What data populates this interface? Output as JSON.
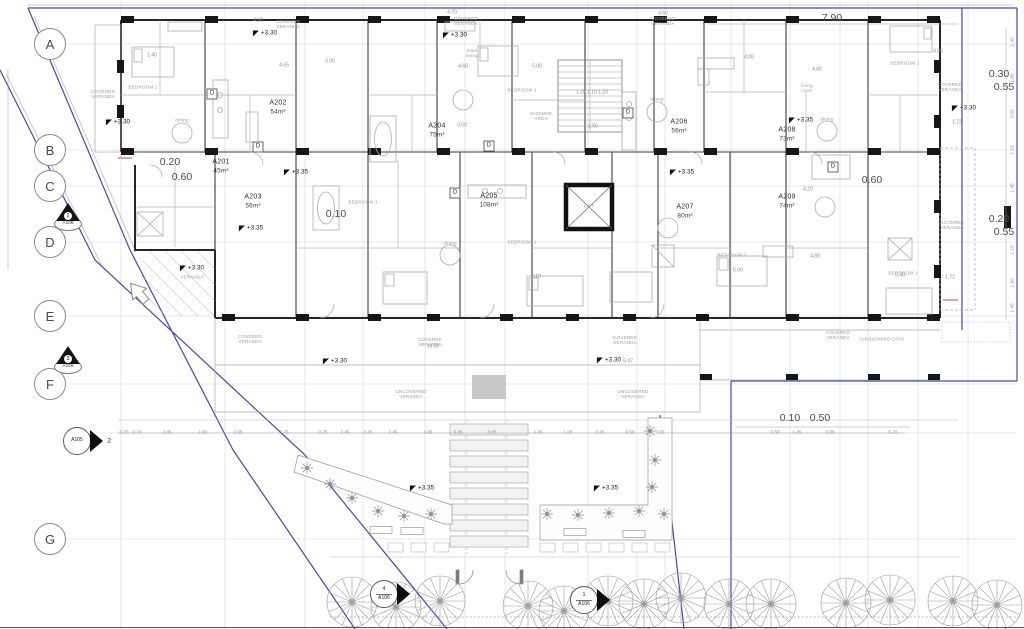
{
  "grid": {
    "x": 50,
    "rows": [
      {
        "label": "A",
        "y": 44
      },
      {
        "label": "B",
        "y": 150
      },
      {
        "label": "C",
        "y": 186
      },
      {
        "label": "D",
        "y": 242
      },
      {
        "label": "E",
        "y": 316
      },
      {
        "label": "F",
        "y": 384
      },
      {
        "label": "G",
        "y": 539
      }
    ]
  },
  "apartments": [
    {
      "id": "A201",
      "area": "45m²",
      "x": 221,
      "y": 167
    },
    {
      "id": "A202",
      "area": "54m²",
      "x": 278,
      "y": 108
    },
    {
      "id": "A203",
      "area": "56m²",
      "x": 253,
      "y": 202
    },
    {
      "id": "A204",
      "area": "75m²",
      "x": 437,
      "y": 131
    },
    {
      "id": "A205",
      "area": "108m²",
      "x": 489,
      "y": 201
    },
    {
      "id": "A206",
      "area": "56m²",
      "x": 679,
      "y": 127
    },
    {
      "id": "A207",
      "area": "80m²",
      "x": 685,
      "y": 212
    },
    {
      "id": "A208",
      "area": "73m²",
      "x": 787,
      "y": 135
    },
    {
      "id": "A209",
      "area": "74m²",
      "x": 787,
      "y": 202
    }
  ],
  "levels": [
    {
      "label": "+3.30",
      "x": 118,
      "y": 122
    },
    {
      "label": "+3.30",
      "x": 265,
      "y": 33
    },
    {
      "label": "+3.30",
      "x": 455,
      "y": 35
    },
    {
      "label": "+3.30",
      "x": 964,
      "y": 108
    },
    {
      "label": "+3.30",
      "x": 192,
      "y": 268
    },
    {
      "label": "+3.30",
      "x": 335,
      "y": 361
    },
    {
      "label": "+3.30",
      "x": 609,
      "y": 360
    },
    {
      "label": "+3.35",
      "x": 296,
      "y": 172
    },
    {
      "label": "+3.35",
      "x": 251,
      "y": 228
    },
    {
      "label": "+3.35",
      "x": 682,
      "y": 172
    },
    {
      "label": "+3.35",
      "x": 801,
      "y": 120
    },
    {
      "label": "+3.35",
      "x": 422,
      "y": 488
    },
    {
      "label": "+3.35",
      "x": 606,
      "y": 488
    }
  ],
  "dimensions_large": [
    {
      "v": "0.20",
      "x": 170,
      "y": 163
    },
    {
      "v": "0.60",
      "x": 182,
      "y": 178
    },
    {
      "v": "0.10",
      "x": 336,
      "y": 215
    },
    {
      "v": "0.60",
      "x": 872,
      "y": 181
    },
    {
      "v": "7.90",
      "x": 832,
      "y": 19
    },
    {
      "v": "0.30",
      "x": 999,
      "y": 75
    },
    {
      "v": "0.55",
      "x": 1004,
      "y": 88
    },
    {
      "v": "0.20",
      "x": 999,
      "y": 220
    },
    {
      "v": "0.55",
      "x": 1004,
      "y": 233
    },
    {
      "v": "0.10",
      "x": 790,
      "y": 419
    },
    {
      "v": "0.50",
      "x": 820,
      "y": 419
    }
  ],
  "dimensions_small": [
    {
      "v": "4.50",
      "x": 258,
      "y": 21
    },
    {
      "v": "4.70",
      "x": 452,
      "y": 13
    },
    {
      "v": "4.50",
      "x": 663,
      "y": 14
    },
    {
      "v": "1.40",
      "x": 152,
      "y": 56
    },
    {
      "v": "3.00",
      "x": 330,
      "y": 62
    },
    {
      "v": "4.65",
      "x": 284,
      "y": 66
    },
    {
      "v": "4.60",
      "x": 463,
      "y": 67
    },
    {
      "v": "5.00",
      "x": 537,
      "y": 67
    },
    {
      "v": "4.00",
      "x": 749,
      "y": 58
    },
    {
      "v": "4.80",
      "x": 817,
      "y": 70
    },
    {
      "v": "4.85",
      "x": 938,
      "y": 52
    },
    {
      "v": "3.50",
      "x": 462,
      "y": 126
    },
    {
      "v": "2.50",
      "x": 593,
      "y": 127
    },
    {
      "v": "1.20 1.10 1.20",
      "x": 592,
      "y": 93
    },
    {
      "v": "3.10",
      "x": 536,
      "y": 277
    },
    {
      "v": "14.00",
      "x": 433,
      "y": 347
    },
    {
      "v": "5.47",
      "x": 628,
      "y": 362
    },
    {
      "v": "4.80",
      "x": 815,
      "y": 257
    },
    {
      "v": "5.00",
      "x": 738,
      "y": 271
    },
    {
      "v": "5.40",
      "x": 900,
      "y": 276
    },
    {
      "v": "4.20",
      "x": 808,
      "y": 190
    },
    {
      "v": "1.72",
      "x": 957,
      "y": 123
    },
    {
      "v": "1.72",
      "x": 950,
      "y": 278
    }
  ],
  "dimensions_bottom": {
    "y": 432,
    "items": [
      {
        "v": "0.70",
        "x": 124
      },
      {
        "v": "0.70",
        "x": 137
      },
      {
        "v": "2.45",
        "x": 167
      },
      {
        "v": "1.60",
        "x": 203
      },
      {
        "v": "2.05",
        "x": 238
      },
      {
        "v": "2.75",
        "x": 284
      },
      {
        "v": "0.75",
        "x": 323
      },
      {
        "v": "2.45",
        "x": 345
      },
      {
        "v": "2.45",
        "x": 368
      },
      {
        "v": "2.45",
        "x": 393
      },
      {
        "v": "1.05",
        "x": 428
      },
      {
        "v": "0.85",
        "x": 458
      },
      {
        "v": "0.85",
        "x": 492
      },
      {
        "v": "2.45",
        "x": 538
      },
      {
        "v": "1.00",
        "x": 568
      },
      {
        "v": "2.45",
        "x": 600
      },
      {
        "v": "0.50",
        "x": 630
      },
      {
        "v": "7.65",
        "x": 660
      },
      {
        "v": "0.50",
        "x": 775
      },
      {
        "v": "1.45",
        "x": 797
      },
      {
        "v": "0.80",
        "x": 830
      },
      {
        "v": "5.20",
        "x": 893
      }
    ]
  },
  "dimensions_right_rotated": {
    "x": 1013,
    "items": [
      {
        "v": "1.45",
        "y": 42
      },
      {
        "v": "1.80",
        "y": 78
      },
      {
        "v": "3.00",
        "y": 114
      },
      {
        "v": "1.15",
        "y": 150
      },
      {
        "v": "1.45",
        "y": 188
      },
      {
        "v": "1.15",
        "y": 250
      },
      {
        "v": "1.80",
        "y": 283
      },
      {
        "v": "1.45",
        "y": 308
      }
    ]
  },
  "room_labels": [
    {
      "t": "COVERED\nVERANDA",
      "x": 288,
      "y": 24
    },
    {
      "t": "COVERED\nVERANDA",
      "x": 466,
      "y": 21
    },
    {
      "t": "COVERED\nVERANDA",
      "x": 663,
      "y": 21
    },
    {
      "t": "COVERED\nVERANDA",
      "x": 950,
      "y": 87
    },
    {
      "t": "COVERED\nVERANDA",
      "x": 103,
      "y": 94
    },
    {
      "t": "COVERED\nVERANDA",
      "x": 952,
      "y": 225
    },
    {
      "t": "COVERED\nVERANDA",
      "x": 250,
      "y": 339
    },
    {
      "t": "COVERED\nVERANDA",
      "x": 430,
      "y": 342
    },
    {
      "t": "COVERED\nVERANDA",
      "x": 625,
      "y": 340
    },
    {
      "t": "COVERED\nVERANDA",
      "x": 838,
      "y": 335
    },
    {
      "t": "UNCOVERED\nVERANDA",
      "x": 411,
      "y": 394
    },
    {
      "t": "UNCOVERED\nVERANDA",
      "x": 633,
      "y": 394
    },
    {
      "t": "VERANDA",
      "x": 192,
      "y": 277
    },
    {
      "t": "BEDROOM 1",
      "x": 143,
      "y": 87
    },
    {
      "t": "BEDROOM 1",
      "x": 522,
      "y": 90
    },
    {
      "t": "BEDROOM 1",
      "x": 905,
      "y": 63
    },
    {
      "t": "BEDROOM 1",
      "x": 363,
      "y": 202
    },
    {
      "t": "BEDROOM 1",
      "x": 522,
      "y": 242
    },
    {
      "t": "BEDROOM 1",
      "x": 732,
      "y": 255
    },
    {
      "t": "BEDROOM 1",
      "x": 903,
      "y": 273
    },
    {
      "t": "main\nliving",
      "x": 472,
      "y": 53
    },
    {
      "t": "living\nroom",
      "x": 807,
      "y": 88
    },
    {
      "t": "dining",
      "x": 182,
      "y": 120
    },
    {
      "t": "dining",
      "x": 657,
      "y": 99
    },
    {
      "t": "dining",
      "x": 450,
      "y": 243
    },
    {
      "t": "dining",
      "x": 827,
      "y": 119
    },
    {
      "t": "SHOWER\nAREA",
      "x": 541,
      "y": 116
    },
    {
      "t": "ΟΙΚΟΔΟΜΙΚΟ ΟΡΙΟ",
      "x": 882,
      "y": 339
    },
    {
      "t": "LIFT",
      "x": 589,
      "y": 206
    }
  ],
  "appliance_labels": [
    {
      "t": "D",
      "x": 212,
      "y": 94
    },
    {
      "t": "D",
      "x": 258,
      "y": 147
    },
    {
      "t": "D",
      "x": 489,
      "y": 146
    },
    {
      "t": "D",
      "x": 455,
      "y": 193
    },
    {
      "t": "D",
      "x": 628,
      "y": 113
    },
    {
      "t": "D",
      "x": 833,
      "y": 167
    }
  ],
  "section_markers": [
    {
      "type": "triangle",
      "num": "2",
      "ref": "A108",
      "x": 68,
      "y": 217
    },
    {
      "type": "triangle",
      "num": "3",
      "ref": "A109",
      "x": 68,
      "y": 360
    },
    {
      "type": "circle-side",
      "num": "2",
      "ref": "A105",
      "x": 77,
      "y": 441
    },
    {
      "type": "circle",
      "num": "4",
      "ref": "A106",
      "x": 384,
      "y": 594
    },
    {
      "type": "circle",
      "num": "1",
      "ref": "A106",
      "x": 584,
      "y": 600
    }
  ],
  "colors": {
    "boundary": "#4848aa",
    "wall": "#262626",
    "annotation": "#4c4c4c",
    "light_line": "#b5b5b5",
    "red_mark": "#cc4444"
  }
}
